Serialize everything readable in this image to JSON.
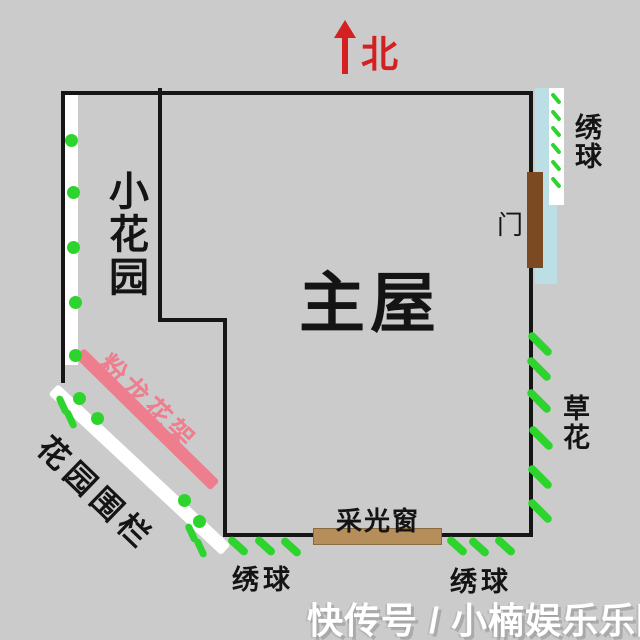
{
  "compass": {
    "north_label": "北"
  },
  "plan": {
    "main_house_label": "主屋",
    "small_garden_label": "小花园",
    "door_label": "门",
    "window_label": "采光窗",
    "trellis_label": "粉龙花架",
    "fence_label": "花园围栏",
    "grass_flower_label": "草花",
    "hydrangea_top_label": "绣球",
    "hydrangea_bottom_left_label": "绣球",
    "hydrangea_bottom_right_label": "绣球"
  },
  "watermark": {
    "text": "快传号 / 小楠娱乐乐园"
  },
  "colors": {
    "background": "#cbcbcb",
    "wall": "#161616",
    "plant_green": "#2ed42e",
    "trellis_pink": "#ee7e8e",
    "door_brown": "#7b4a22",
    "window_tan": "#b68e5a",
    "hydrangea_blue": "#bcdfe6",
    "north_red": "#d42020"
  }
}
